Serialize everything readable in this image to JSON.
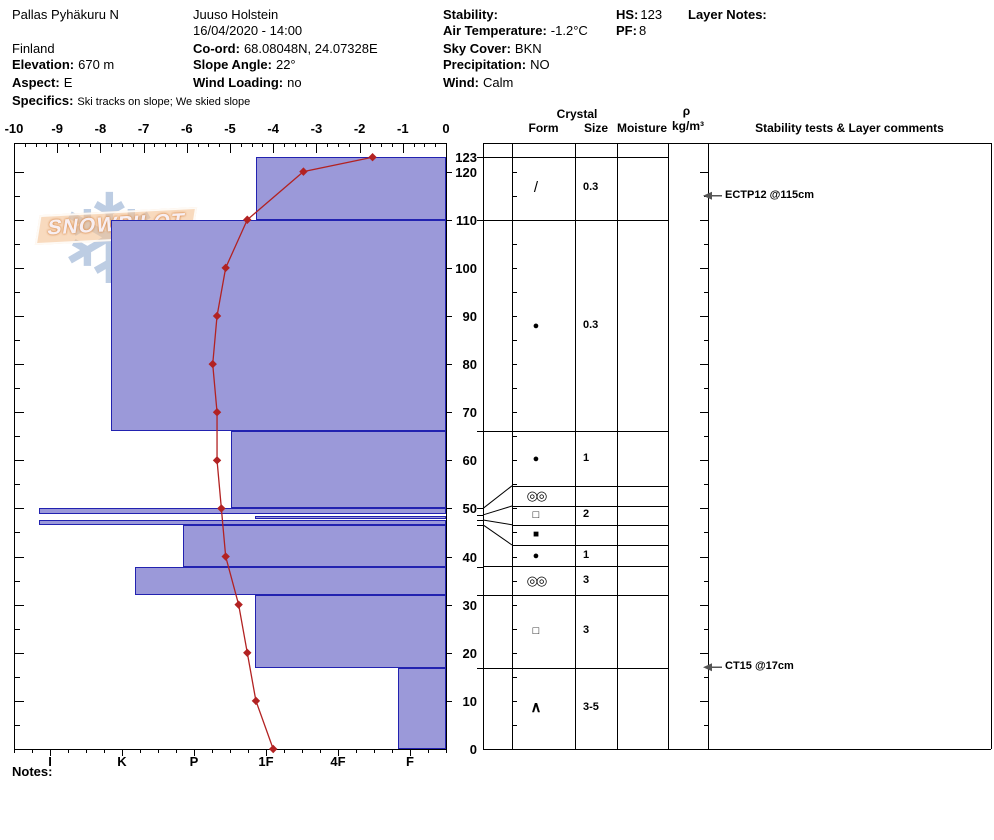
{
  "header": {
    "site_name": "Pallas Pyhäkuru N",
    "country": "Finland",
    "elevation_label": "Elevation:",
    "elevation_value": "670 m",
    "aspect_label": "Aspect:",
    "aspect_value": "E",
    "specifics_label": "Specifics:",
    "specifics_value": "Ski tracks on slope; We skied slope",
    "observer": "Juuso Holstein",
    "datetime": "16/04/2020 - 14:00",
    "coord_label": "Co-ord:",
    "coord_value": "68.08048N, 24.07328E",
    "slope_angle_label": "Slope Angle:",
    "slope_angle_value": "22°",
    "wind_loading_label": "Wind Loading:",
    "wind_loading_value": "no",
    "stability_label": "Stability:",
    "stability_value": "",
    "air_temp_label": "Air Temperature:",
    "air_temp_value": "-1.2°C",
    "sky_cover_label": "Sky Cover:",
    "sky_cover_value": "BKN",
    "precipitation_label": "Precipitation:",
    "precipitation_value": "NO",
    "wind_label": "Wind:",
    "wind_value": "Calm",
    "hs_label": "HS:",
    "hs_value": "123",
    "pf_label": "PF:",
    "pf_value": "8",
    "layer_notes_label": "Layer Notes:"
  },
  "watermark": {
    "brand": "SNOWPILOT",
    "snowflake_icon": "❄"
  },
  "table_header": {
    "crystal": "Crystal",
    "form": "Form",
    "size": "Size",
    "moisture": "Moisture",
    "rho": "ρ",
    "rho_unit": "kg/m³",
    "comments": "Stability tests & Layer comments"
  },
  "notes_label": "Notes:",
  "colors": {
    "bar_fill": "#9b99d9",
    "bar_border": "#2222b0",
    "temp_line": "#b22222",
    "annotation_arrow": "#555555"
  },
  "chart_data": {
    "type": "snow-profile",
    "title": "SnowPilot snow pit profile",
    "height_axis": {
      "unit": "cm",
      "min": 0,
      "max": 126,
      "snow_height": 123,
      "labels": [
        123,
        120,
        110,
        100,
        90,
        80,
        70,
        60,
        50,
        40,
        30,
        20,
        10,
        0
      ]
    },
    "temp_axis": {
      "unit": "°C",
      "min": -10,
      "max": 0,
      "ticks": [
        -10,
        -9,
        -8,
        -7,
        -6,
        -5,
        -4,
        -3,
        -2,
        -1,
        0
      ]
    },
    "hardness_axis": {
      "categories": [
        "I",
        "K",
        "P",
        "1F",
        "4F",
        "F"
      ]
    },
    "temperature_profile": [
      {
        "height": 123,
        "temp": -1.7
      },
      {
        "height": 120,
        "temp": -3.3
      },
      {
        "height": 110,
        "temp": -4.6
      },
      {
        "height": 100,
        "temp": -5.1
      },
      {
        "height": 90,
        "temp": -5.3
      },
      {
        "height": 80,
        "temp": -5.4
      },
      {
        "height": 70,
        "temp": -5.3
      },
      {
        "height": 60,
        "temp": -5.3
      },
      {
        "height": 50,
        "temp": -5.2
      },
      {
        "height": 40,
        "temp": -5.1
      },
      {
        "height": 30,
        "temp": -4.8
      },
      {
        "height": 20,
        "temp": -4.6
      },
      {
        "height": 10,
        "temp": -4.4
      },
      {
        "height": 0,
        "temp": -4.0
      }
    ],
    "layers": [
      {
        "top": 123,
        "bottom": 110,
        "hardness": "1F",
        "hardness_pos": 3.36,
        "symbol": "/",
        "grain_type": "decomposing fragments (DF)",
        "size": "0.3"
      },
      {
        "top": 110,
        "bottom": 66,
        "hardness": "K",
        "hardness_pos": 1.35,
        "symbol": "●",
        "grain_type": "rounded grains (RG)",
        "size": "0.3"
      },
      {
        "top": 66,
        "bottom": 50,
        "hardness": "P-",
        "hardness_pos": 3.01,
        "symbol": "●",
        "grain_type": "rounded grains (RG)",
        "size": "1",
        "row_bottom": 54.7
      },
      {
        "top": 50,
        "bottom": 48.8,
        "hardness": "I",
        "hardness_pos": 0.35,
        "symbol": "◎◎",
        "grain_type": "melt-freeze crust (MFcr)",
        "size": "",
        "row_top": 54.7,
        "row_bottom": 50.5
      },
      {
        "top": 48.5,
        "bottom": 47.7,
        "hardness": "1F",
        "hardness_pos": 3.35,
        "symbol": "□",
        "grain_type": "faceted crystals (FC)",
        "size": "2",
        "row_top": 50.5,
        "row_bottom": 46.6
      },
      {
        "top": 47.5,
        "bottom": 46.6,
        "hardness": "I",
        "hardness_pos": 0.35,
        "symbol": "■",
        "grain_type": "ice formation (IF)",
        "size": "",
        "row_top": 46.6,
        "row_bottom": 42.4
      },
      {
        "top": 46.6,
        "bottom": 37.9,
        "hardness": "P",
        "hardness_pos": 2.35,
        "symbol": "●",
        "grain_type": "rounded grains (RG)",
        "size": "1",
        "row_top": 42.4,
        "row_bottom": 38
      },
      {
        "top": 37.9,
        "bottom": 32,
        "hardness": "K+",
        "hardness_pos": 1.68,
        "symbol": "◎◎",
        "grain_type": "melt forms (MF)",
        "size": "3"
      },
      {
        "top": 32,
        "bottom": 16.9,
        "hardness": "1F",
        "hardness_pos": 3.35,
        "symbol": "□",
        "grain_type": "faceted crystals (FC)",
        "size": "3"
      },
      {
        "top": 16.9,
        "bottom": 0,
        "hardness": "F",
        "hardness_pos": 5.33,
        "symbol": "∧",
        "grain_type": "depth hoar (DH)",
        "size": "3-5"
      }
    ],
    "stability_tests": [
      {
        "label": "ECTP12 @115cm",
        "height": 115
      },
      {
        "label": "CT15 @17cm",
        "height": 17
      }
    ]
  }
}
